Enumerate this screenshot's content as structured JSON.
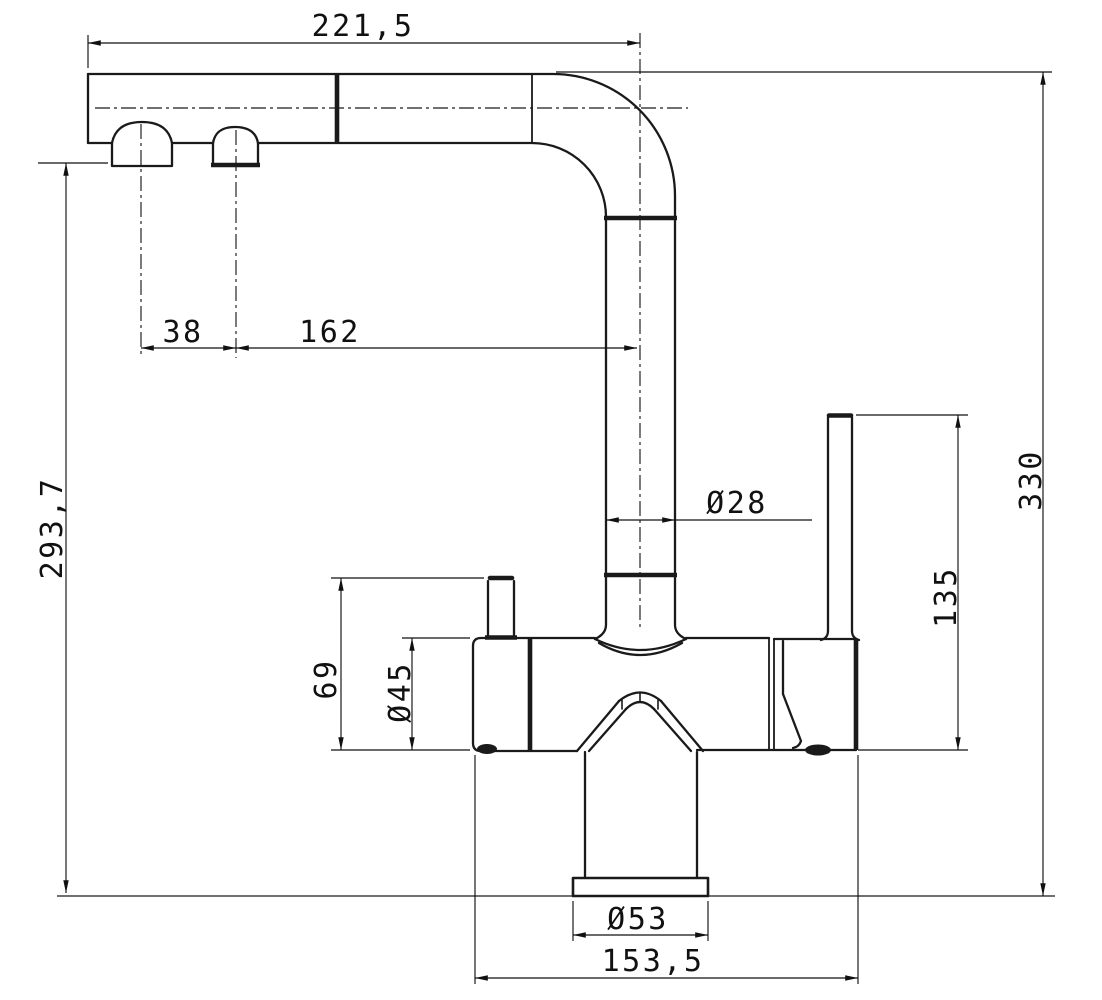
{
  "drawing": {
    "title": "Three-way kitchen faucet dimensioned technical drawing",
    "view": "side elevation",
    "units": "mm",
    "line_color": "#1a1a1a",
    "background_color": "#ffffff"
  },
  "dimensions": {
    "spout_reach": "221,5",
    "nozzle_spacing": "38",
    "nozzle_to_riser_axis": "162",
    "riser_diameter": "Ø28",
    "total_height": "330",
    "handle_top_height": "135",
    "spout_underside_height": "293,7",
    "knob_height": "69",
    "body_diameter": "Ø45",
    "base_diameter": "Ø53",
    "body_length": "153,5"
  }
}
